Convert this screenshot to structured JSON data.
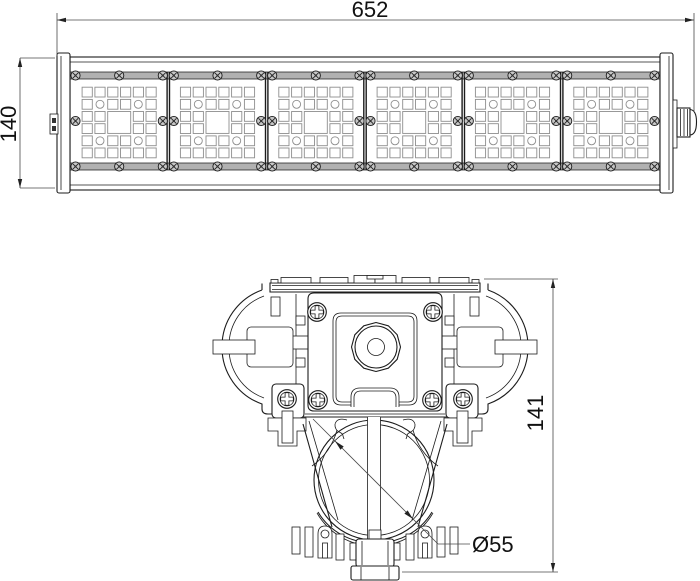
{
  "drawing": {
    "labels": {
      "length": "652",
      "height": "140",
      "section_height": "141",
      "mount_diameter": "Ø55"
    },
    "top_view": {
      "led_module_count": 6,
      "led_grid": {
        "cols": 6,
        "rows": 6,
        "circle_cells": [
          [
            1,
            1
          ],
          [
            1,
            4
          ],
          [
            4,
            1
          ],
          [
            4,
            4
          ]
        ],
        "center_square": {
          "row": 2,
          "col": 2,
          "span": 2
        }
      }
    },
    "colors": {
      "line": "#1c1c1c",
      "dim_line": "#4a4a4a",
      "rail_gray": "#b1b1b1",
      "led_grid_line": "#8e8e8e",
      "screw_fill": "#c6c6c6"
    }
  }
}
